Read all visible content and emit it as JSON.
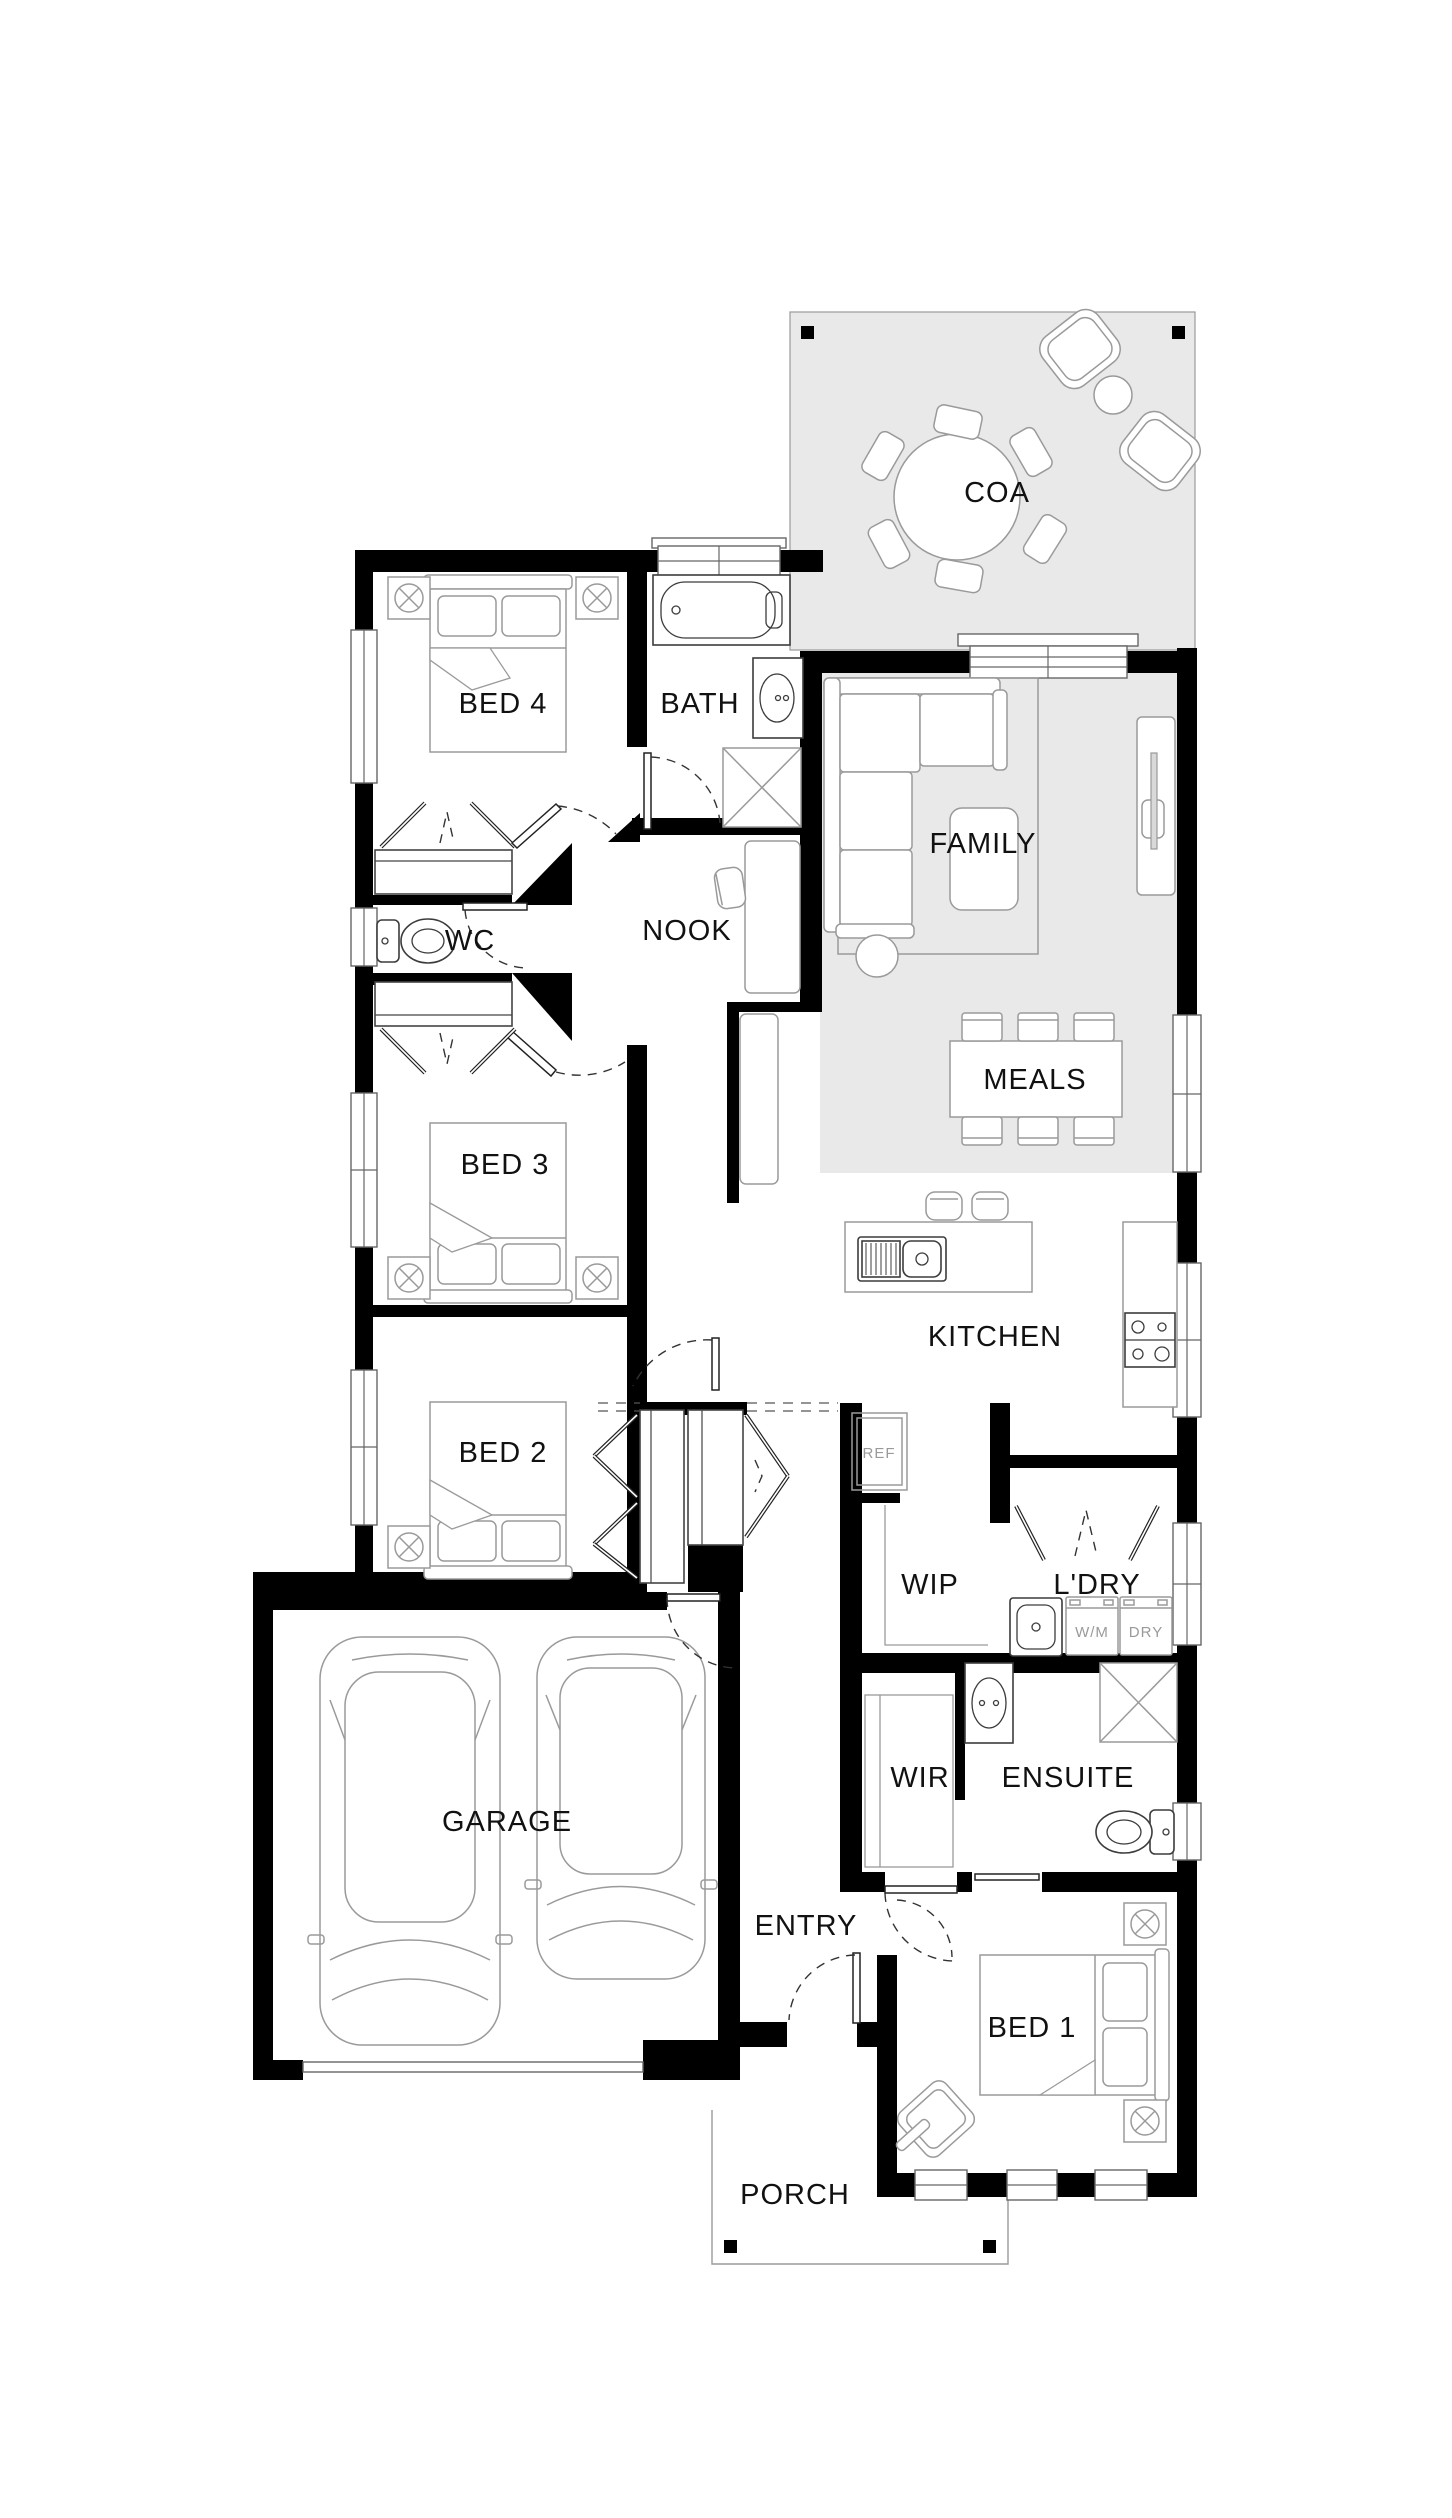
{
  "palette": {
    "wall_color": "#000000",
    "zone_fill": "#e9e9e9",
    "furniture_stroke": "#9a9a9a",
    "label_color": "#111111",
    "appliance_label_color": "#9a9a9a"
  },
  "rooms": {
    "coa": "COA",
    "bed4": "BED 4",
    "bath": "BATH",
    "family": "FAMILY",
    "wc": "WC",
    "nook": "NOOK",
    "meals": "MEALS",
    "bed3": "BED 3",
    "kitchen": "KITCHEN",
    "bed2": "BED 2",
    "wip": "WIP",
    "ldry": "L'DRY",
    "wir": "WIR",
    "ensuite": "ENSUITE",
    "garage": "GARAGE",
    "entry": "ENTRY",
    "bed1": "BED 1",
    "porch": "PORCH"
  },
  "appliances": {
    "ref": "REF",
    "wm": "W/M",
    "dry": "DRY"
  }
}
